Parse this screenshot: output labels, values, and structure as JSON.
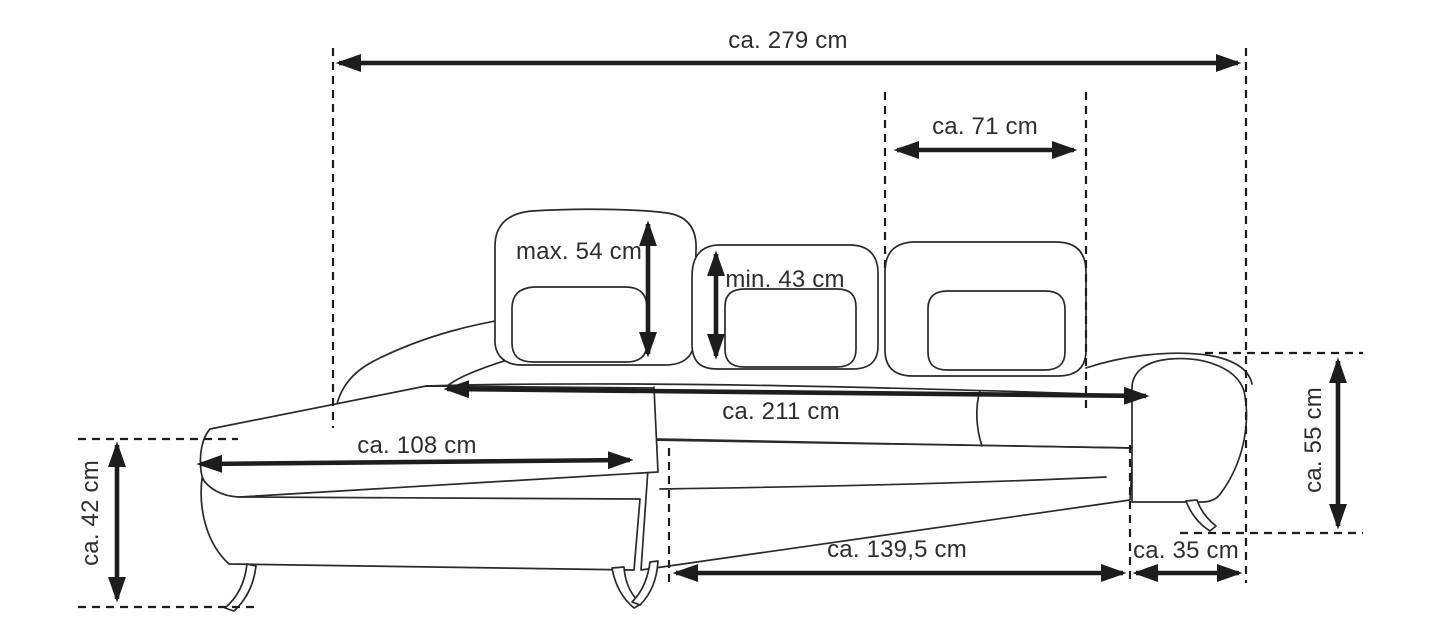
{
  "diagram": {
    "type": "furniture-dimension-diagram",
    "subject": "corner sofa with chaise longue, line drawing with dimension arrows",
    "unit": "cm",
    "colors": {
      "background": "#ffffff",
      "outline": "#2a2a2a",
      "arrow": "#1d1d1d",
      "text": "#2e2e2e"
    },
    "dimensions": {
      "total_width": {
        "text": "ca. 279 cm",
        "value_cm": 279
      },
      "backrest_cushion_width": {
        "text": "ca. 71 cm",
        "value_cm": 71
      },
      "backrest_height_max": {
        "text": "max. 54 cm",
        "value_cm": 54
      },
      "backrest_height_min": {
        "text": "min. 43 cm",
        "value_cm": 43
      },
      "seat_width": {
        "text": "ca. 211 cm",
        "value_cm": 211
      },
      "chaise_length": {
        "text": "ca. 108 cm",
        "value_cm": 108
      },
      "seat_height": {
        "text": "ca. 42 cm",
        "value_cm": 42
      },
      "armrest_height": {
        "text": "ca. 55 cm",
        "value_cm": 55
      },
      "front_seat_width": {
        "text": "ca. 139,5 cm",
        "value_cm": 139.5
      },
      "armrest_width": {
        "text": "ca. 35 cm",
        "value_cm": 35
      }
    }
  }
}
